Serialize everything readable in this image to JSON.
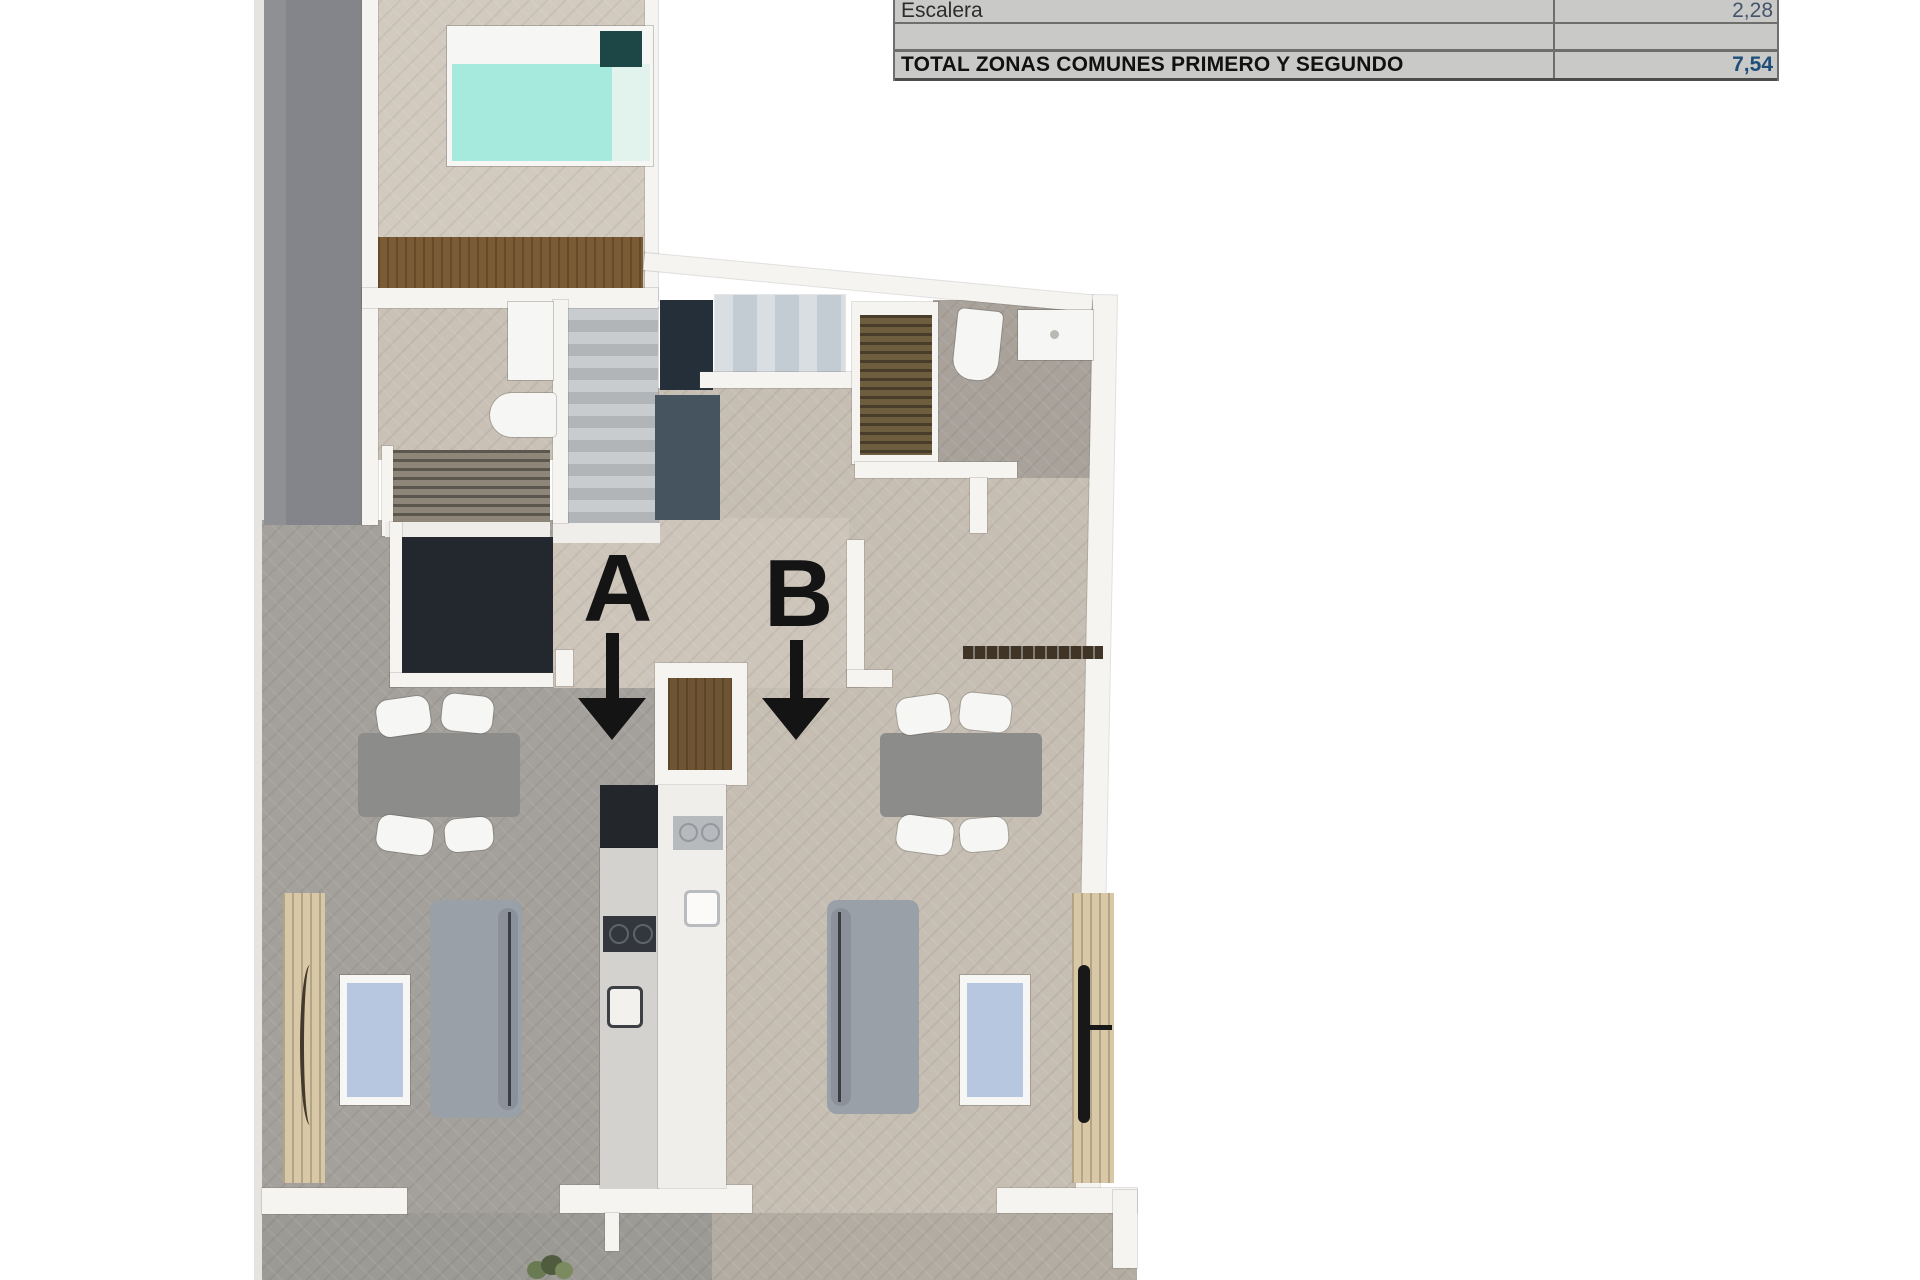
{
  "table": {
    "rows": [
      {
        "label": "Escalera",
        "value": "2,28"
      },
      {
        "label": "",
        "value": ""
      },
      {
        "label": "TOTAL ZONAS COMUNES PRIMERO Y SEGUNDO",
        "value": "7,54"
      }
    ]
  },
  "plan": {
    "label_a": "A",
    "label_b": "B"
  },
  "colors": {
    "table_background": "#c9c9c7",
    "table_value_blue": "#44546a",
    "table_total_blue": "#1f4e79",
    "floor_beige": "#c7bfb4",
    "floor_gray": "#a4a09b",
    "terrace_gray": "#9c9a95",
    "dark_band_gray": "#85878b",
    "stair_navy": "#242f39",
    "stair_bluegray": "#46545f",
    "bed_teal": "#a6e9dd",
    "sofa_gray": "#99a0a8",
    "wood_light": "#d9c8a6",
    "wood_brown": "#7b5a36",
    "tv_panel_blue": "#b7c7e0"
  }
}
